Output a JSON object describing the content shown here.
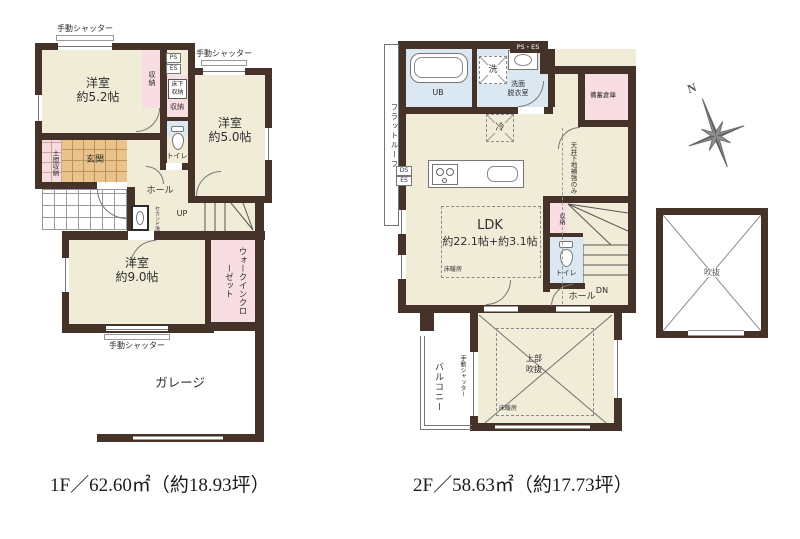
{
  "f1": {
    "caption": "1F／62.60㎡（約18.93坪）",
    "shutter": "手動シャッター",
    "room52_name": "洋室",
    "room52_size": "約5.2帖",
    "room50_name": "洋室",
    "room50_size": "約5.0帖",
    "room90_name": "洋室",
    "room90_size": "約9.0帖",
    "closet": "収納",
    "ps": "PS",
    "es": "ES",
    "underfloor_l1": "床下",
    "underfloor_l2": "収納",
    "closet2": "収納",
    "toilet": "トイレ",
    "doma": "土間収納",
    "genkan": "玄関",
    "hall": "ホール",
    "second_basin": "セカンド洗面",
    "up": "UP",
    "wic": "ウォークインクローゼット",
    "garage": "ガレージ"
  },
  "f2": {
    "caption": "2F／58.63㎡（約17.73坪）",
    "flat_roof": "フラットルーフ",
    "ub": "UB",
    "washer": "洗",
    "ps_es": "PS・ES",
    "senmen_l1": "洗面",
    "senmen_l2": "脱衣室",
    "bichiku": "備蓄倉庫",
    "fridge": "冷",
    "ceiling_note": "天井下地補強のみ",
    "ds": "DS",
    "es": "ES",
    "ldk_name": "LDK",
    "ldk_size": "約22.1帖+約3.1帖",
    "floor_heating": "床暖房",
    "closet": "収納",
    "toilet": "トイレ",
    "dn": "DN",
    "hall": "ホール",
    "void_l1": "上部",
    "void_l2": "吹抜",
    "balcony": "バルコニー",
    "shutter": "手動シャッター",
    "void_square": "吹抜",
    "north": "N"
  }
}
